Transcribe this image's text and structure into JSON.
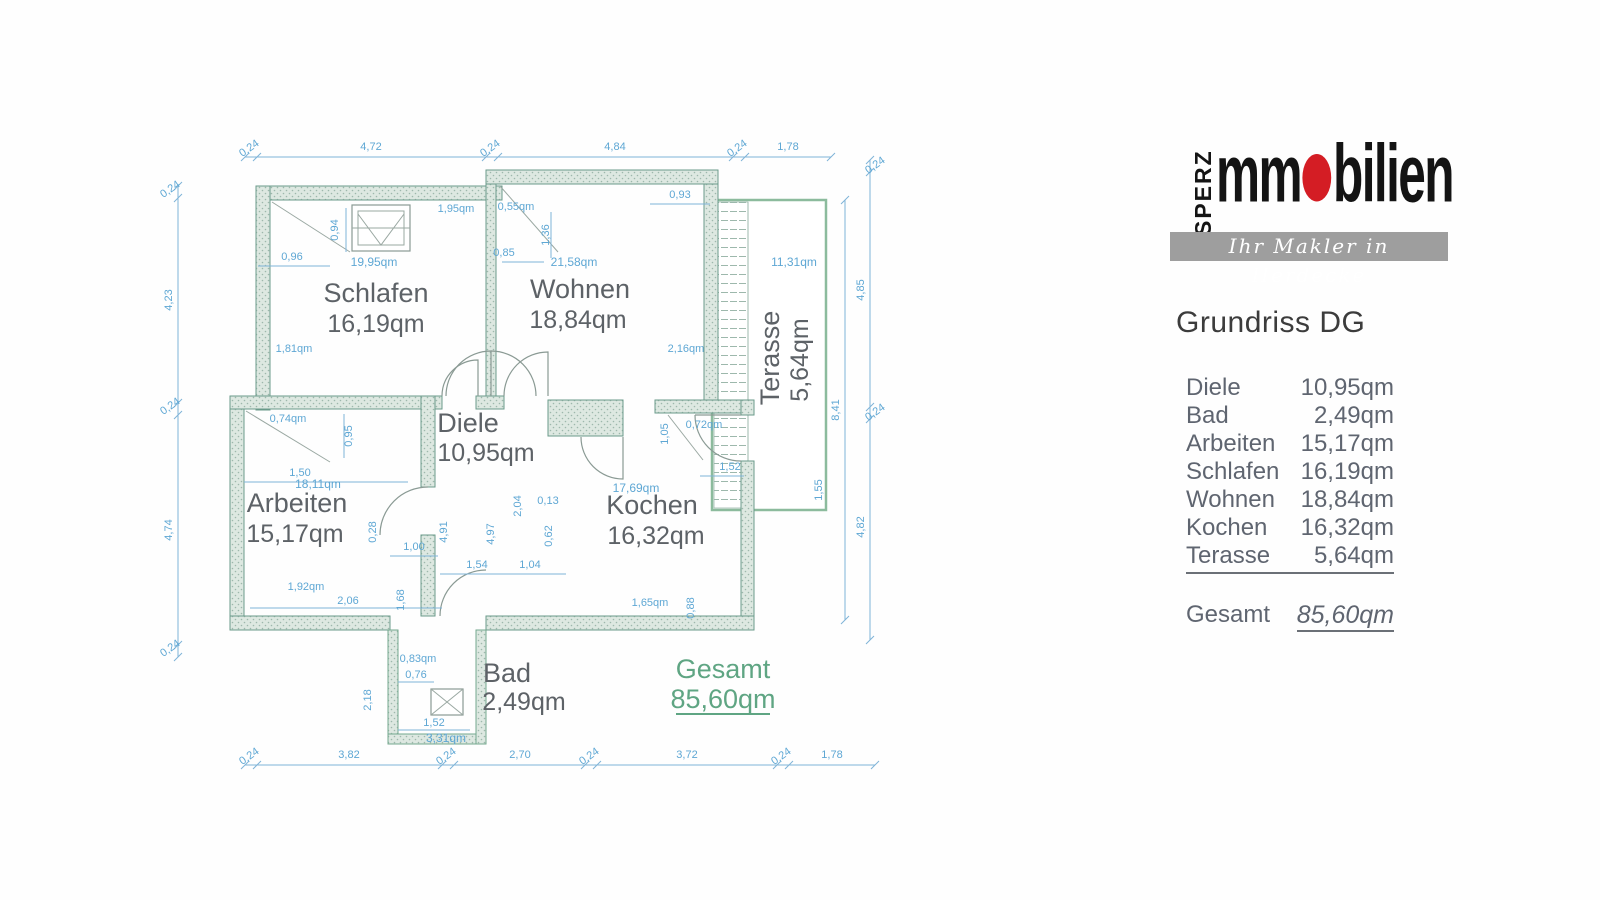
{
  "branding": {
    "vertical": "SPERZ",
    "word_start": "mm",
    "word_end": "bilien",
    "tagline": "Ihr Makler in Herdecke"
  },
  "heading": {
    "title": "Grundriss DG"
  },
  "summary": {
    "rows": [
      {
        "label": "Diele",
        "value": "10,95qm"
      },
      {
        "label": "Bad",
        "value": "2,49qm"
      },
      {
        "label": "Arbeiten",
        "value": "15,17qm"
      },
      {
        "label": "Schlafen",
        "value": "16,19qm"
      },
      {
        "label": "Wohnen",
        "value": "18,84qm"
      },
      {
        "label": "Kochen",
        "value": "16,32qm"
      },
      {
        "label": "Terasse",
        "value": "5,64qm"
      }
    ],
    "total": {
      "label": "Gesamt",
      "value": "85,60qm"
    }
  },
  "plan": {
    "rooms": {
      "schlafen": {
        "name": "Schlafen",
        "area": "16,19qm",
        "raw": "19,95qm"
      },
      "wohnen": {
        "name": "Wohnen",
        "area": "18,84qm",
        "raw": "21,58qm"
      },
      "diele": {
        "name": "Diele",
        "area": "10,95qm"
      },
      "arbeiten": {
        "name": "Arbeiten",
        "area": "15,17qm",
        "raw": "18,11qm"
      },
      "kochen": {
        "name": "Kochen",
        "area": "16,32qm",
        "raw": "17,69qm"
      },
      "bad": {
        "name": "Bad",
        "area": "2,49qm",
        "raw": "3,31qm"
      },
      "terasse": {
        "name": "Terasse",
        "area": "5,64qm",
        "raw": "11,31qm"
      }
    },
    "total": {
      "label": "Gesamt",
      "value": "85,60qm"
    },
    "dims": {
      "top": [
        "0,24",
        "4,72",
        "0,24",
        "4,84",
        "0,24",
        "1,78"
      ],
      "bottom": [
        "0,24",
        "3,82",
        "0,24",
        "2,70",
        "0,24",
        "3,72",
        "0,24",
        "1,78"
      ],
      "left": [
        "0,24",
        "4,23",
        "0,24",
        "4,74",
        "0,24"
      ],
      "right": [
        "0,24",
        "4,85",
        "0,24",
        "4,82"
      ],
      "right_inner": "8,41",
      "schlafen": [
        "0,94",
        "1,95qm",
        "0,96",
        "1,81qm"
      ],
      "wohnen": [
        "0,55qm",
        "1,36",
        "0,85",
        "0,93",
        "2,16qm"
      ],
      "arbeiten": [
        "0,74qm",
        "0,95",
        "1,50",
        "1,92qm",
        "2,06",
        "1,00",
        "1,68",
        "0,28"
      ],
      "diele": [
        "4,91",
        "4,97",
        "2,04",
        "0,13",
        "0,62",
        "1,54",
        "1,04"
      ],
      "kochen": [
        "0,72qm",
        "1,05",
        "1,52",
        "1,65qm",
        "0,88",
        "1,55"
      ],
      "bad": [
        "0,83qm",
        "0,76",
        "1,52",
        "2,18"
      ],
      "terasse": [
        "11,31qm"
      ]
    }
  },
  "colors": {
    "accent_red": "#d41d24",
    "wall_teal": "#6a9a8a",
    "dim_blue": "#5ea7d4",
    "label_gray": "#5d6267",
    "total_green": "#5fa583",
    "terrace_green": "#8cbb9d",
    "bar_gray": "#9e9e9e"
  }
}
